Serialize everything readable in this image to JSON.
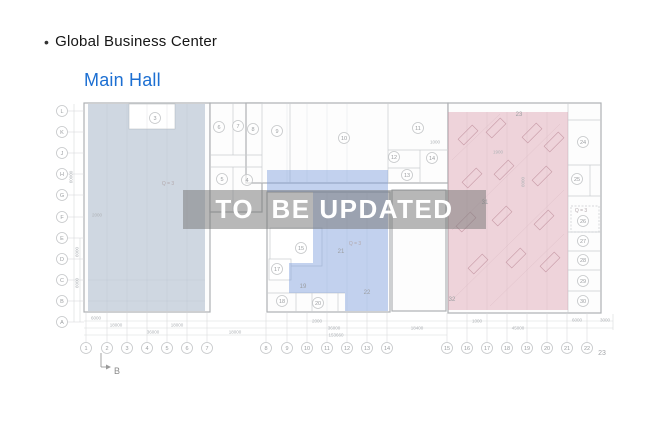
{
  "header": {
    "bullet": "•",
    "title": "Global Business Center",
    "subtitle": "Main Hall",
    "title_color": "#161616",
    "subtitle_color": "#1c6fd2"
  },
  "watermark": {
    "text": "TO  BE UPDATED",
    "band_color": "rgba(118,118,118,0.52)",
    "text_color": "#ffffff"
  },
  "plan": {
    "overlays": {
      "left_zone_color": "rgba(151,169,190,0.45)",
      "middle_zone_color": "rgba(122,156,219,0.45)",
      "right_zone_color": "rgba(213,143,160,0.38)"
    },
    "axis_letters": [
      {
        "label": "L",
        "y": 111
      },
      {
        "label": "K",
        "y": 132
      },
      {
        "label": "J",
        "y": 153
      },
      {
        "label": "H",
        "y": 174
      },
      {
        "label": "G",
        "y": 195
      },
      {
        "label": "F",
        "y": 217
      },
      {
        "label": "E",
        "y": 238
      },
      {
        "label": "D",
        "y": 259
      },
      {
        "label": "C",
        "y": 280
      },
      {
        "label": "B",
        "y": 301
      },
      {
        "label": "A",
        "y": 322
      }
    ],
    "axis_numbers": [
      {
        "label": "1",
        "x": 86
      },
      {
        "label": "2",
        "x": 107
      },
      {
        "label": "3",
        "x": 127
      },
      {
        "label": "4",
        "x": 147
      },
      {
        "label": "5",
        "x": 167
      },
      {
        "label": "6",
        "x": 187
      },
      {
        "label": "7",
        "x": 207
      },
      {
        "label": "8",
        "x": 266
      },
      {
        "label": "9",
        "x": 287
      },
      {
        "label": "10",
        "x": 307
      },
      {
        "label": "11",
        "x": 327
      },
      {
        "label": "12",
        "x": 347
      },
      {
        "label": "13",
        "x": 367
      },
      {
        "label": "14",
        "x": 387
      },
      {
        "label": "15",
        "x": 447
      },
      {
        "label": "16",
        "x": 467
      },
      {
        "label": "17",
        "x": 487
      },
      {
        "label": "18",
        "x": 507
      },
      {
        "label": "19",
        "x": 527
      },
      {
        "label": "20",
        "x": 547
      },
      {
        "label": "21",
        "x": 567
      },
      {
        "label": "22",
        "x": 587
      }
    ],
    "axis_number_plain": {
      "label": "23",
      "x": 602,
      "y": 353
    },
    "rooms_circled": [
      {
        "label": "3",
        "x": 155,
        "y": 118
      },
      {
        "label": "6",
        "x": 219,
        "y": 127
      },
      {
        "label": "7",
        "x": 238,
        "y": 126
      },
      {
        "label": "8",
        "x": 253,
        "y": 129
      },
      {
        "label": "9",
        "x": 277,
        "y": 131
      },
      {
        "label": "10",
        "x": 344,
        "y": 138
      },
      {
        "label": "11",
        "x": 418,
        "y": 128
      },
      {
        "label": "12",
        "x": 394,
        "y": 157
      },
      {
        "label": "13",
        "x": 407,
        "y": 175
      },
      {
        "label": "14",
        "x": 432,
        "y": 158
      },
      {
        "label": "5",
        "x": 222,
        "y": 179
      },
      {
        "label": "4",
        "x": 247,
        "y": 180
      },
      {
        "label": "15",
        "x": 301,
        "y": 248
      },
      {
        "label": "17",
        "x": 277,
        "y": 269
      },
      {
        "label": "18",
        "x": 282,
        "y": 301
      },
      {
        "label": "20",
        "x": 318,
        "y": 303
      },
      {
        "label": "24",
        "x": 583,
        "y": 142
      },
      {
        "label": "25",
        "x": 577,
        "y": 179
      },
      {
        "label": "26",
        "x": 583,
        "y": 221
      },
      {
        "label": "27",
        "x": 583,
        "y": 241
      },
      {
        "label": "28",
        "x": 583,
        "y": 260
      },
      {
        "label": "29",
        "x": 583,
        "y": 281
      },
      {
        "label": "30",
        "x": 583,
        "y": 301
      }
    ],
    "rooms_plain": [
      {
        "label": "19",
        "x": 303,
        "y": 286
      },
      {
        "label": "21",
        "x": 341,
        "y": 251
      },
      {
        "label": "22",
        "x": 367,
        "y": 292
      },
      {
        "label": "23",
        "x": 519,
        "y": 114
      },
      {
        "label": "31",
        "x": 485,
        "y": 202
      },
      {
        "label": "32",
        "x": 452,
        "y": 299
      }
    ],
    "annotations": [
      {
        "text": "Q = 3",
        "x": 168,
        "y": 183
      },
      {
        "text": "Q = 3",
        "x": 355,
        "y": 243
      },
      {
        "text": "Q = 3",
        "x": 581,
        "y": 210
      }
    ],
    "dimensions": [
      {
        "text": "6000",
        "x": 96,
        "y": 318
      },
      {
        "text": "18000",
        "x": 116,
        "y": 325
      },
      {
        "text": "18000",
        "x": 177,
        "y": 325
      },
      {
        "text": "36000",
        "x": 153,
        "y": 332
      },
      {
        "text": "18000",
        "x": 235,
        "y": 332
      },
      {
        "text": "2000",
        "x": 317,
        "y": 321
      },
      {
        "text": "36000",
        "x": 334,
        "y": 328
      },
      {
        "text": "153660",
        "x": 336,
        "y": 335
      },
      {
        "text": "18400",
        "x": 417,
        "y": 328
      },
      {
        "text": "1000",
        "x": 477,
        "y": 321
      },
      {
        "text": "45000",
        "x": 518,
        "y": 328
      },
      {
        "text": "6000",
        "x": 577,
        "y": 320
      },
      {
        "text": "3000",
        "x": 605,
        "y": 320
      },
      {
        "text": "1000",
        "x": 435,
        "y": 142
      },
      {
        "text": "1900",
        "x": 498,
        "y": 152
      },
      {
        "text": "2000",
        "x": 97,
        "y": 215
      },
      {
        "text": "60000",
        "x": 71,
        "y": 177,
        "rot": -90
      },
      {
        "text": "6000",
        "x": 77,
        "y": 252,
        "rot": -90
      },
      {
        "text": "6000",
        "x": 77,
        "y": 283,
        "rot": -90
      },
      {
        "text": "6000",
        "x": 523,
        "y": 182,
        "rot": -90
      }
    ],
    "section_marker": {
      "label": "B"
    }
  }
}
